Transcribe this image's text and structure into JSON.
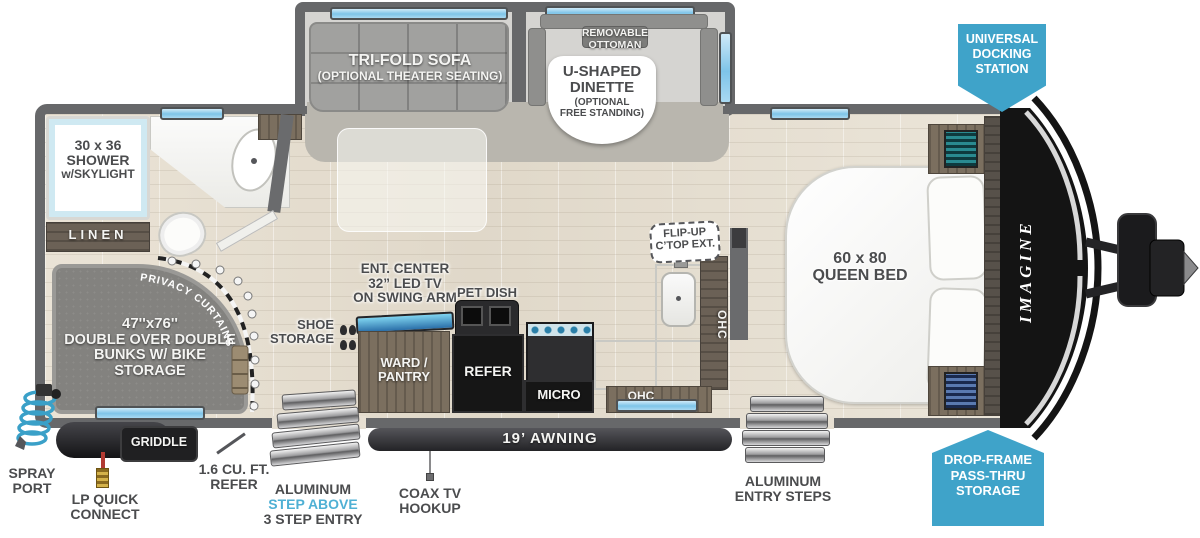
{
  "colors": {
    "badge_blue": "#3fa3c9",
    "accent_blue": "#4fb0d4",
    "window_blue": "#7ec4e8",
    "wall_gray": "#67686a",
    "label_gray": "#4b4c4e"
  },
  "slideout": {
    "sofa_label": "TRI-FOLD SOFA",
    "sofa_sub": "(OPTIONAL THEATER SEATING)",
    "ottoman_line1": "REMOVABLE",
    "ottoman_line2": "OTTOMAN",
    "dinette_line1": "U-SHAPED",
    "dinette_line2": "DINETTE",
    "dinette_sub1": "(OPTIONAL",
    "dinette_sub2": "FREE STANDING)"
  },
  "badges": {
    "docking_line1": "UNIVERSAL",
    "docking_line2": "DOCKING",
    "docking_line3": "STATION",
    "storage_line1": "DROP-FRAME",
    "storage_line2": "PASS-THRU",
    "storage_line3": "STORAGE"
  },
  "bathroom": {
    "shower_line1": "30 x 36",
    "shower_line2": "SHOWER",
    "shower_line3": "w/SKYLIGHT",
    "linen": "LINEN"
  },
  "bunks": {
    "size": "47''x76''",
    "line2": "DOUBLE OVER DOUBLE",
    "line3": "BUNKS W/ BIKE STORAGE",
    "privacy": "PRIVACY CURTAINS"
  },
  "kitchen": {
    "ent_line1": "ENT. CENTER",
    "ent_line2": "32” LED TV",
    "ent_line3": "ON SWING ARM",
    "pet_dish": "PET DISH",
    "shoe_line1": "SHOE",
    "shoe_line2": "STORAGE",
    "ward_line1": "WARD /",
    "ward_line2": "PANTRY",
    "refer": "REFER",
    "micro": "MICRO",
    "flip_line1": "FLIP-UP",
    "flip_line2": "C’TOP EXT.",
    "ohc_side": "OHC",
    "ohc_bottom": "OHC"
  },
  "bedroom": {
    "bed_line1": "60 x 80",
    "bed_line2": "QUEEN BED",
    "overhead": "OVERHEAD CABINETS",
    "brand": "IMAGINE"
  },
  "exterior": {
    "awning": "19’ AWNING",
    "coax_line1": "COAX TV",
    "coax_line2": "HOOKUP",
    "step_line1": "ALUMINUM",
    "step_line2": "STEP ABOVE",
    "step_line3": "3 STEP ENTRY",
    "entry_line1": "ALUMINUM",
    "entry_line2": "ENTRY STEPS",
    "spray_line1": "SPRAY",
    "spray_line2": "PORT",
    "lp_line1": "LP QUICK",
    "lp_line2": "CONNECT",
    "griddle": "GRIDDLE",
    "refer_line1": "1.6 CU. FT.",
    "refer_line2": "REFER"
  }
}
